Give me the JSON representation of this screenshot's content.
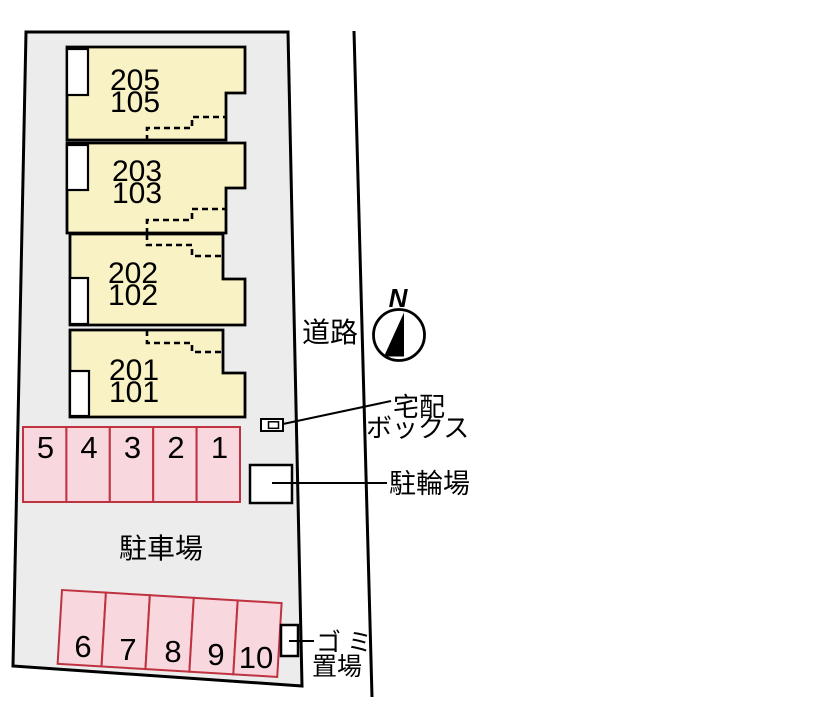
{
  "units": [
    {
      "upper": "205",
      "lower": "105"
    },
    {
      "upper": "203",
      "lower": "103"
    },
    {
      "upper": "202",
      "lower": "102"
    },
    {
      "upper": "201",
      "lower": "101"
    }
  ],
  "parking": {
    "lot_label": "駐車場",
    "row_top": [
      "5",
      "4",
      "3",
      "2",
      "1"
    ],
    "row_bottom": [
      "6",
      "7",
      "8",
      "9",
      "10"
    ]
  },
  "labels": {
    "road": "道路",
    "north": "N",
    "delivery_box_line1": "宅配",
    "delivery_box_line2": "ボックス",
    "bicycle_parking": "駐輪場",
    "garbage_line1": "ゴミ",
    "garbage_line2": "置場"
  },
  "colors": {
    "site_fill": "#ececec",
    "unit_fill": "#f8f2c4",
    "parking_fill": "#f9d7de",
    "parking_stroke": "#bf3240",
    "outline": "#000000",
    "background": "#ffffff"
  }
}
